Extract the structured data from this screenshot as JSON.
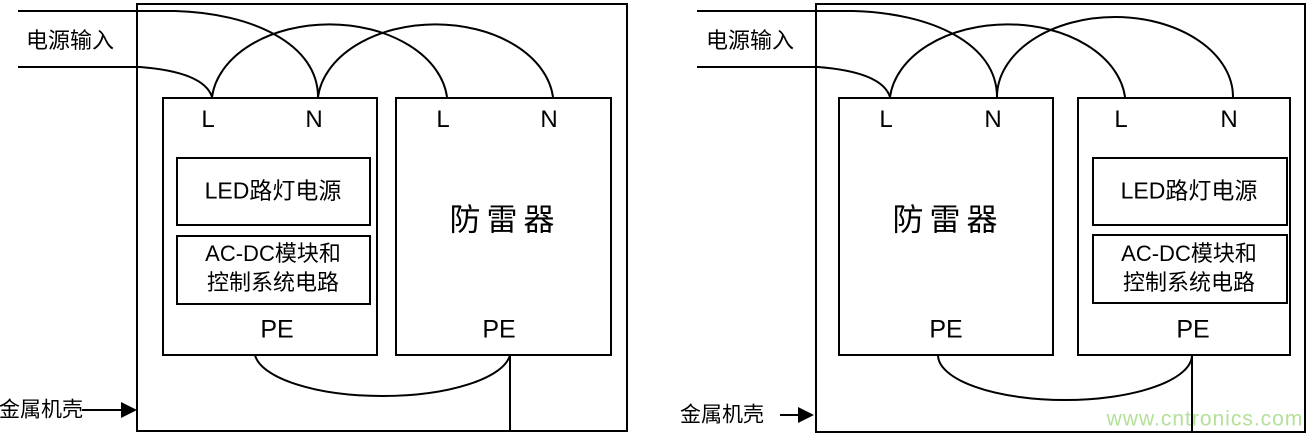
{
  "canvas": {
    "background": "#ffffff",
    "line_color": "#000000"
  },
  "labels": {
    "power_input": "电源输入",
    "enclosure": "金属机壳",
    "terminal_l": "L",
    "terminal_n": "N",
    "pe": "PE",
    "led_driver": "LED路灯电源",
    "acdc_module_line1": "AC-DC模块和",
    "acdc_module_line2": "控制系统电路",
    "surge_protector": "防雷器"
  },
  "watermark": {
    "text": "www.cntronics.com",
    "color": "#b4e09a"
  }
}
